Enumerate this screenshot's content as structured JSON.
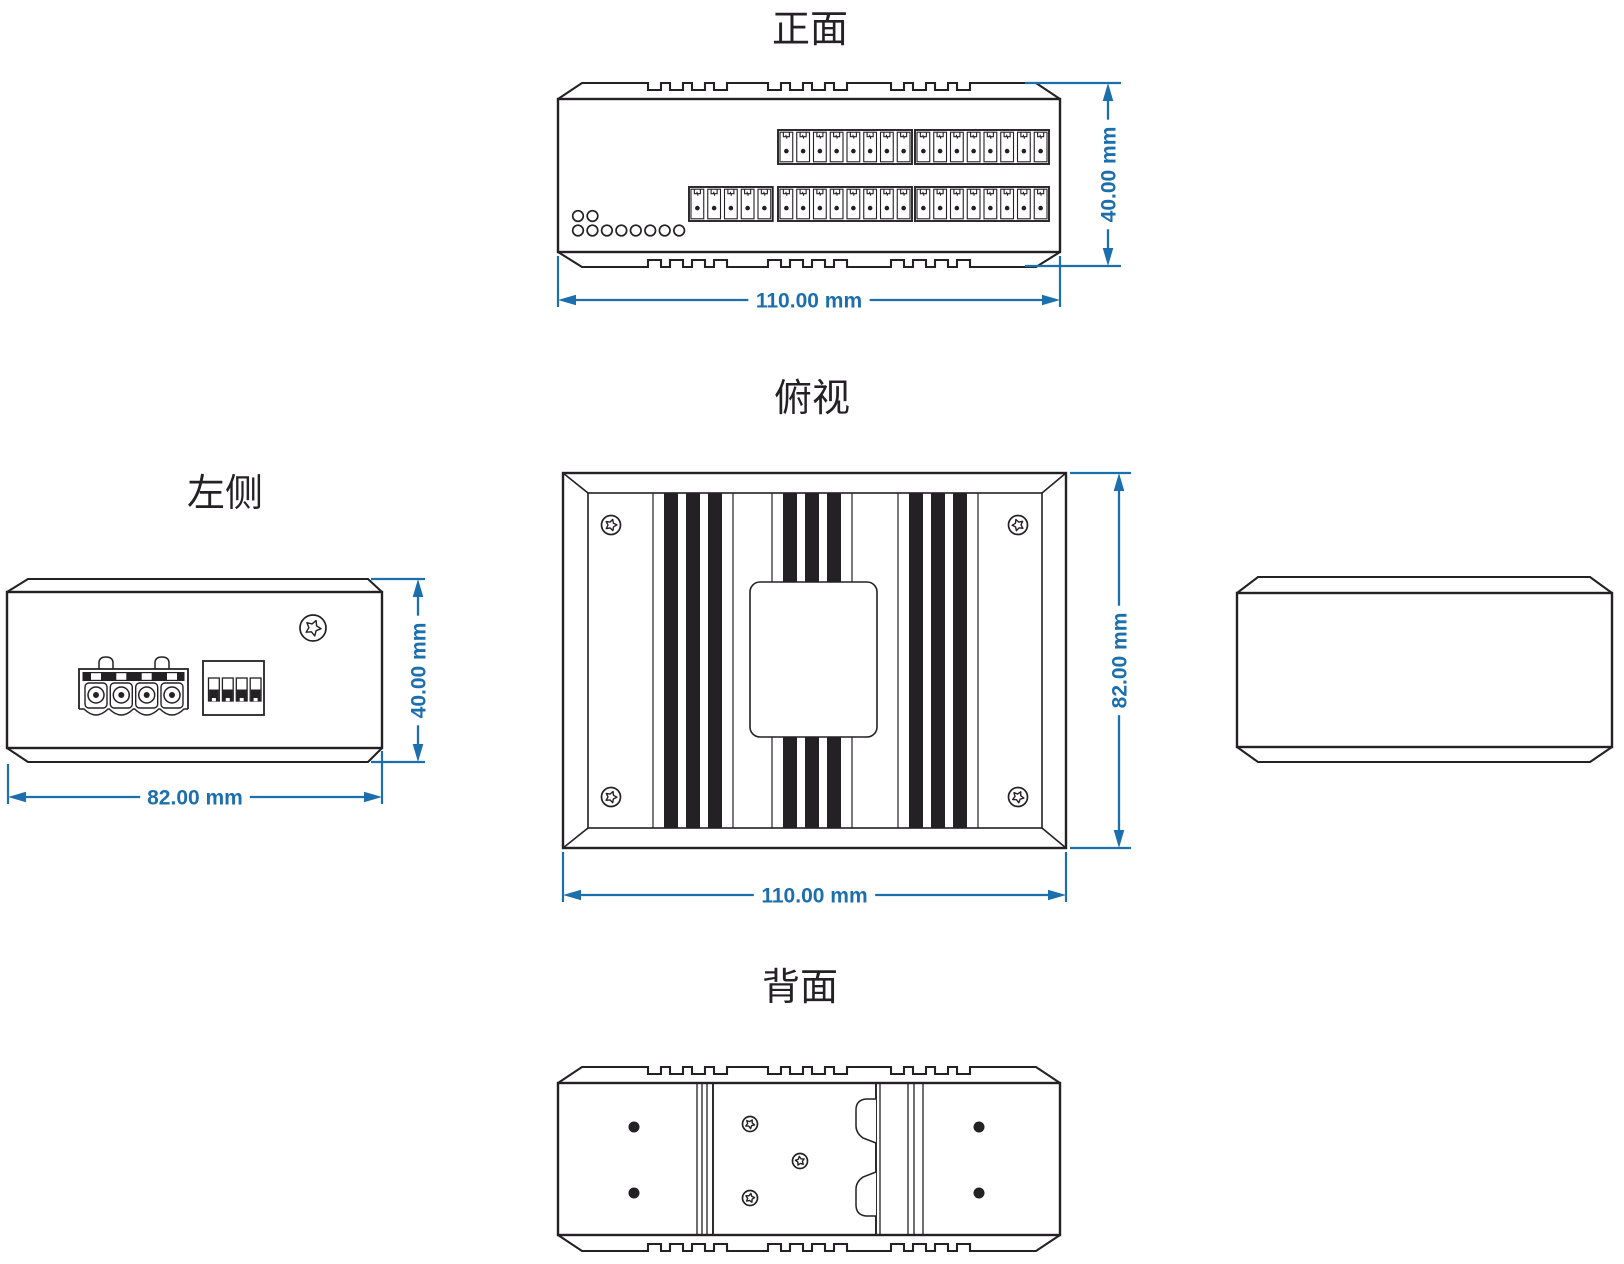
{
  "drawing": {
    "colors": {
      "line": "#242124",
      "dimension": "#1C6FAD"
    },
    "front": {
      "title": "正面",
      "dim_width": "110.00 mm",
      "dim_height": "40.00 mm",
      "terminal_top_groups": [
        8,
        8
      ],
      "terminal_bottom_groups": [
        5,
        8,
        8
      ],
      "led_top_count": 2,
      "led_bottom_count": 8,
      "vent_groups": 3,
      "vents_per_group": 4
    },
    "top": {
      "title": "俯视",
      "dim_width": "110.00 mm",
      "dim_height": "82.00 mm",
      "fin_groups": 3,
      "fins_per_group": 3,
      "corner_screw_count": 4,
      "has_center_label_plate": true
    },
    "left": {
      "title": "左侧",
      "dim_width": "82.00 mm",
      "dim_height": "40.00 mm",
      "power_terminal_count": 4,
      "dip_switch_count": 4,
      "screw_count": 1
    },
    "right": {
      "title": ""
    },
    "back": {
      "title": "背面",
      "mount_screw_count": 3,
      "hole_count": 4,
      "vent_groups": 3,
      "vents_per_group": 4
    }
  }
}
